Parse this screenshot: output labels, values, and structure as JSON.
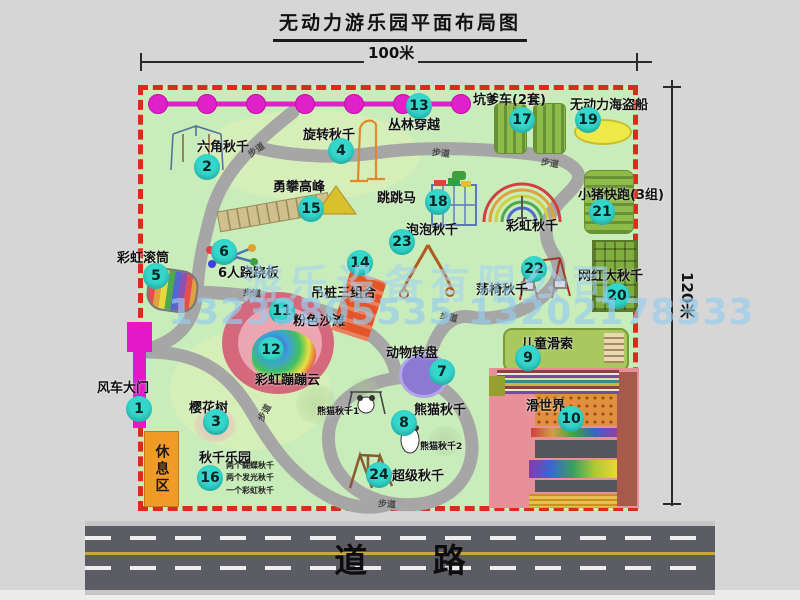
{
  "title": "无动力游乐园平面布局图",
  "dimensions": {
    "top": "100米",
    "right": "120米"
  },
  "road": {
    "label": "道 路"
  },
  "watermark": {
    "company": "游乐设备有限公司",
    "phones": "13233805535 13202178333"
  },
  "walkway_label": "步道",
  "rest_area_label": "休息区",
  "rainbow_swing_label": "彩虹秋千",
  "panda_sub_labels": {
    "one": "熊猫秋千1",
    "two": "熊猫秋千2"
  },
  "swing_park_notes": [
    "两个蝴蝶秋千",
    "两个发光秋千",
    "一个彩虹秋千"
  ],
  "colors": {
    "badge": "#35d6cb",
    "border_dash": "#dc2a1c",
    "gate": "#e318c8",
    "chain": "#e020c8",
    "rest_area": "#f09a28",
    "map_bg": "#c9ecbb",
    "path": "#a6a6a6",
    "road": "#5c5c64"
  },
  "attractions": [
    {
      "num": "1",
      "name": "风车大门"
    },
    {
      "num": "2",
      "name": "六角秋千"
    },
    {
      "num": "3",
      "name": "樱花树"
    },
    {
      "num": "4",
      "name": "旋转秋千"
    },
    {
      "num": "5",
      "name": "彩虹滚筒"
    },
    {
      "num": "6",
      "name": "6人跷跷板"
    },
    {
      "num": "7",
      "name": "动物转盘"
    },
    {
      "num": "8",
      "name": "熊猫秋千"
    },
    {
      "num": "9",
      "name": "儿童滑索"
    },
    {
      "num": "10",
      "name": "滑世界"
    },
    {
      "num": "11",
      "name": "粉色沙滩"
    },
    {
      "num": "12",
      "name": "彩虹蹦蹦云"
    },
    {
      "num": "13",
      "name": "丛林穿越"
    },
    {
      "num": "14",
      "name": "吊桩三组合"
    },
    {
      "num": "15",
      "name": "勇攀高峰"
    },
    {
      "num": "16",
      "name": "秋千乐园"
    },
    {
      "num": "17",
      "name": "坑爹车(2套)"
    },
    {
      "num": "18",
      "name": "跳跳马"
    },
    {
      "num": "19",
      "name": "无动力海盗船"
    },
    {
      "num": "20",
      "name": "网红大秋千"
    },
    {
      "num": "21",
      "name": "小猪快跑(3组)"
    },
    {
      "num": "22",
      "name": "荡椅秋千"
    },
    {
      "num": "23",
      "name": "泡泡秋千"
    },
    {
      "num": "24",
      "name": "超级秋千"
    }
  ]
}
